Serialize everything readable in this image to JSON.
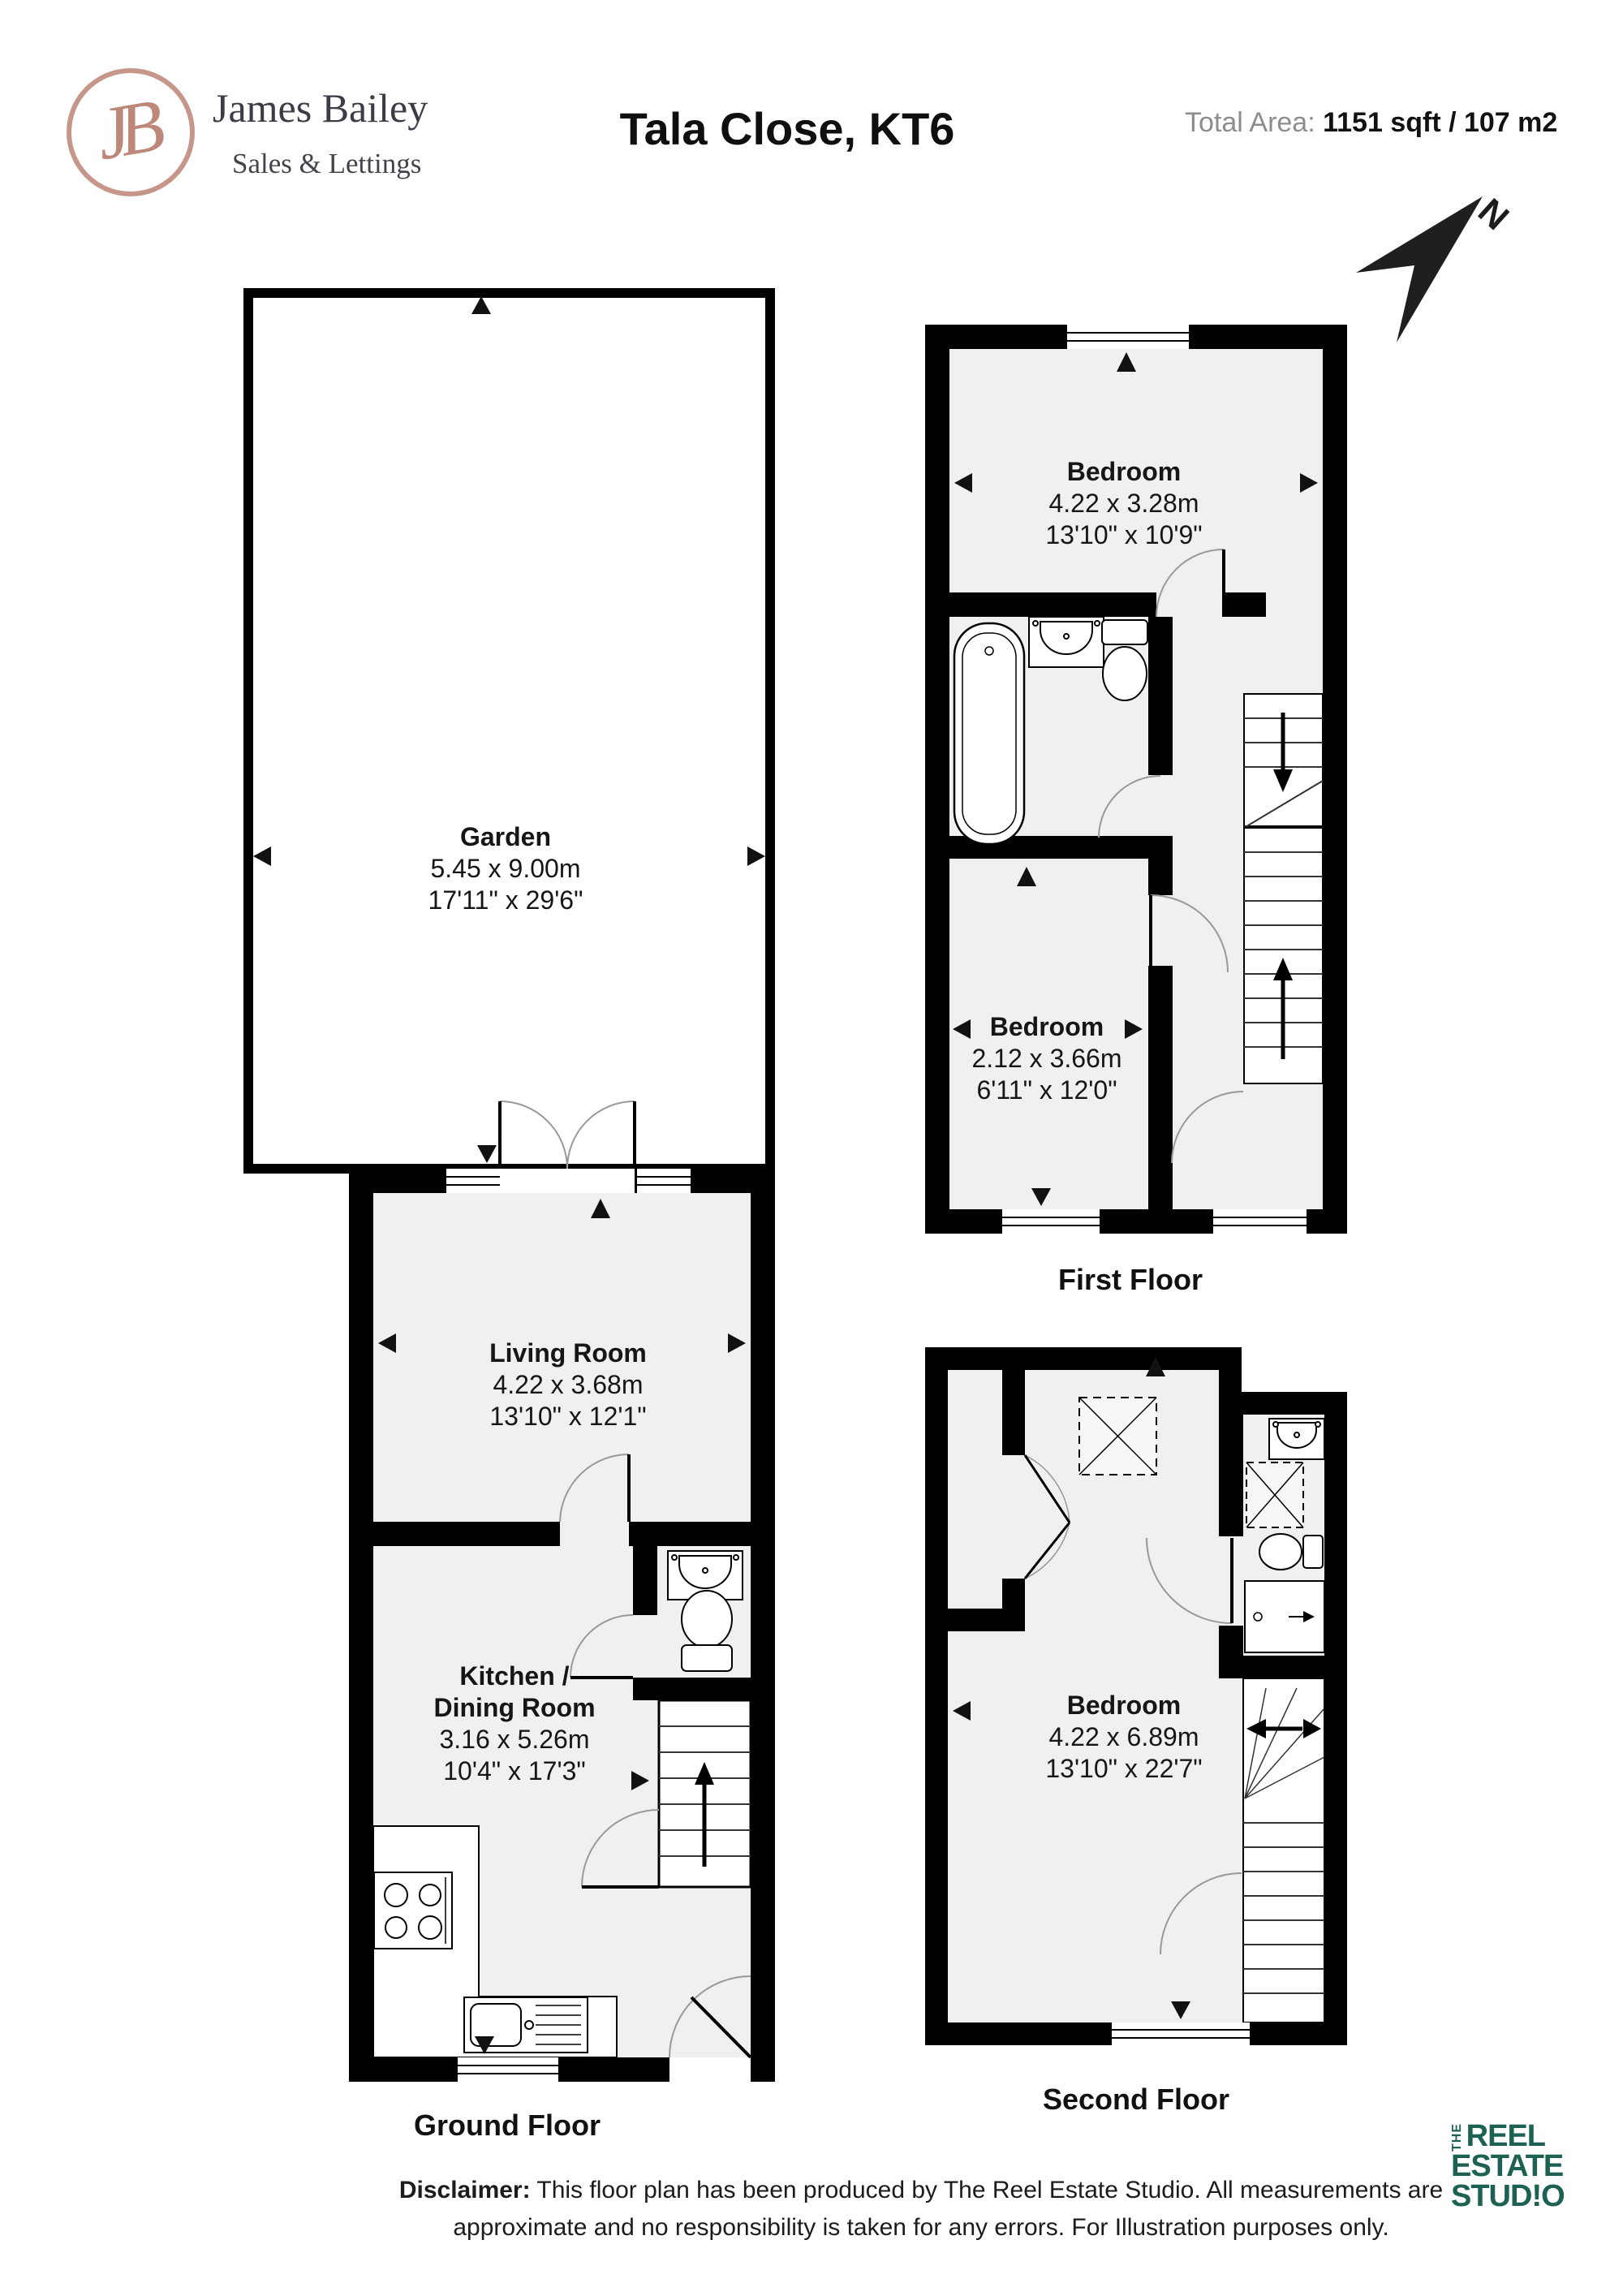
{
  "header": {
    "brand_initials": "JB",
    "brand_name": "James Bailey",
    "brand_tagline": "Sales & Lettings",
    "title": "Tala Close, KT6",
    "total_area_label": "Total Area:",
    "total_area_value": "1151 sqft / 107 m2",
    "north_label": "N"
  },
  "rooms": {
    "garden": {
      "name": "Garden",
      "metric": "5.45 x 9.00m",
      "imperial": "17'11\" x 29'6\""
    },
    "living_room": {
      "name": "Living Room",
      "metric": "4.22 x 3.68m",
      "imperial": "13'10\" x 12'1\""
    },
    "kitchen": {
      "name_line1": "Kitchen /",
      "name_line2": "Dining Room",
      "metric": "3.16 x 5.26m",
      "imperial": "10'4\" x 17'3\""
    },
    "bedroom_first_large": {
      "name": "Bedroom",
      "metric": "4.22 x 3.28m",
      "imperial": "13'10\" x 10'9\""
    },
    "bedroom_first_small": {
      "name": "Bedroom",
      "metric": "2.12 x 3.66m",
      "imperial": "6'11\" x 12'0\""
    },
    "bedroom_second": {
      "name": "Bedroom",
      "metric": "4.22 x 6.89m",
      "imperial": "13'10\" x 22'7\""
    }
  },
  "floor_labels": {
    "ground": "Ground Floor",
    "first": "First Floor",
    "second": "Second Floor"
  },
  "footer": {
    "disclaimer_label": "Disclaimer:",
    "disclaimer_text": " This floor plan has been produced by The Reel Estate Studio. All measurements are approximate and no responsibility is taken for any errors. For Illustration purposes only.",
    "studio": {
      "the": "THE",
      "line1": "REEL",
      "line2": "ESTATE",
      "line3": "STUD!O"
    }
  },
  "colors": {
    "wall": "#000000",
    "room_fill": "#f0f0f0",
    "brand_rose": "#bd8779",
    "brand_text": "#3d3c46",
    "studio_green": "#1d6152",
    "muted_gray": "#8d8d8d"
  }
}
